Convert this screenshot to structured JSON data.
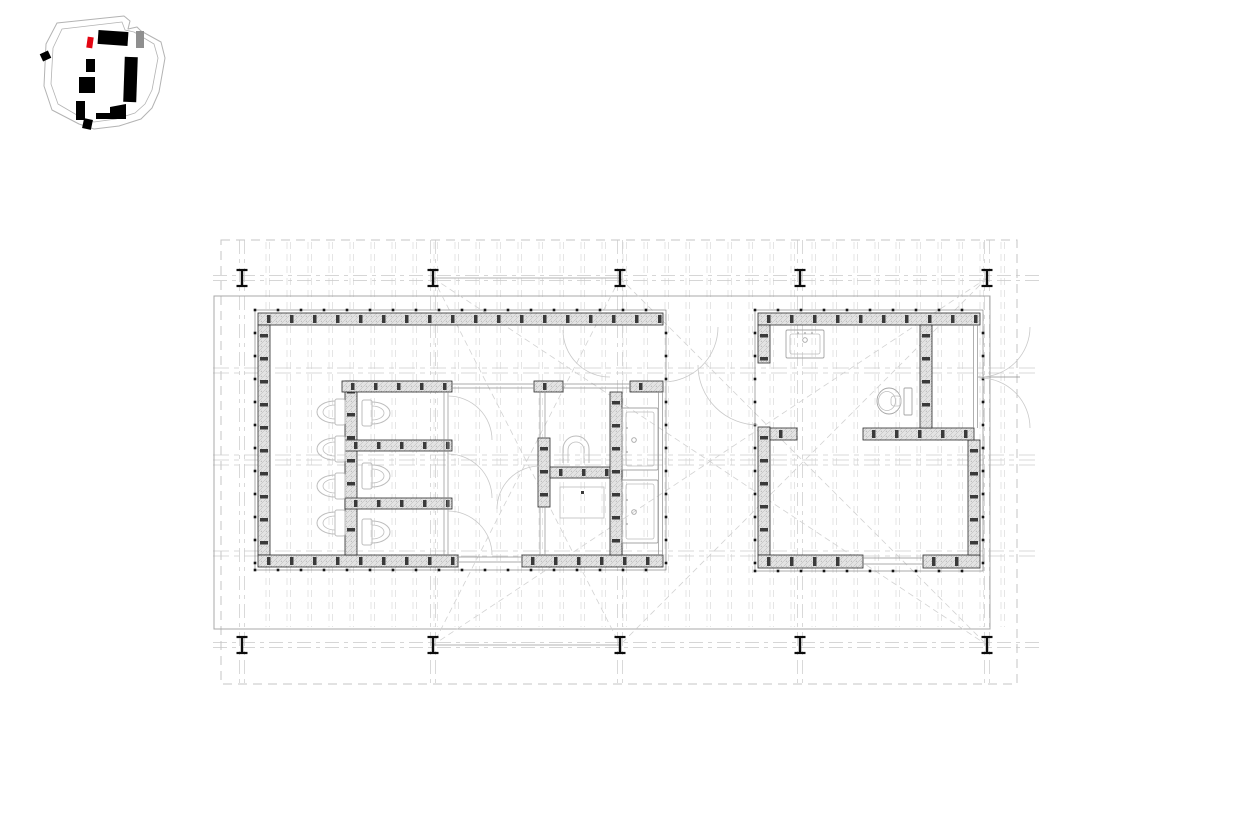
{
  "page": {
    "background": "#ffffff",
    "description": "architectural floor plan, ground level, two pavilions on a deck with column grid and site key map"
  },
  "palette": {
    "wall_edge": "#2b2b2b",
    "wall_fill": "#e3e3e3",
    "hatch_line": "#b4b4b4",
    "hatch_dot": "#9c9c9c",
    "stud": "#3a3a3a",
    "trim": "#707070",
    "trim_dot": "#161616",
    "glazing": "#8f8f8f",
    "fixture_light": "#bdbdbd",
    "fixture_mid": "#a6a6a6",
    "arc": "#c9c9c9",
    "board": "#dadada",
    "grid": "#c9c9c9",
    "boundary": "#c6c6c6",
    "utility": "#cccccc",
    "deck_edge": "#a8a8a8",
    "canopy": "#b3b3b3",
    "brace": "#d2d2d2",
    "column": "#0d0d0d",
    "site_outline": "#b3b3b3",
    "site_building": "#000000",
    "site_highlight": "#e30613",
    "site_secondary": "#8f8f8f"
  },
  "site_map": {
    "outer_outline": "57,23 124,16 130,21 128,29 137,27 141,31 161,42 165,58 159,92 152,108 141,119 119,126 94,129 79,124 52,110 44,86 46,44",
    "inner_outline": "62,29 122,22 125,30 134,32 154,44 158,58 152,90 145,104 135,113 116,119 94,122 82,118 58,104 51,84 53,48",
    "buildings": [
      {
        "x": 98,
        "y": 31,
        "w": 30,
        "h": 14,
        "rot": 4,
        "type": "building"
      },
      {
        "x": 136,
        "y": 31,
        "w": 8,
        "h": 17,
        "rot": 0,
        "type": "secondary"
      },
      {
        "x": 41,
        "y": 52,
        "w": 9,
        "h": 8,
        "rot": -25,
        "type": "building"
      },
      {
        "x": 86,
        "y": 59,
        "w": 9,
        "h": 13,
        "rot": 0,
        "type": "building"
      },
      {
        "x": 79,
        "y": 77,
        "w": 16,
        "h": 16,
        "rot": 0,
        "type": "building"
      },
      {
        "x": 124,
        "y": 57,
        "w": 13,
        "h": 45,
        "rot": 2,
        "type": "building"
      },
      {
        "x": 76,
        "y": 101,
        "w": 9,
        "h": 19,
        "rot": 0,
        "type": "building"
      },
      {
        "x": 83,
        "y": 119,
        "w": 9,
        "h": 10,
        "rot": 12,
        "type": "building"
      },
      {
        "x": 87,
        "y": 37,
        "w": 6,
        "h": 11,
        "rot": 8,
        "type": "highlight"
      }
    ],
    "steps_polygon": "96,113 110,113 110,107 126,104 126,119 96,119"
  },
  "plan": {
    "boundary": [
      221,
      240,
      796,
      444
    ],
    "deck": [
      214,
      296,
      776,
      333
    ],
    "grid": {
      "cols": [
        242,
        433,
        620,
        800,
        987
      ],
      "rows": [
        278,
        645
      ],
      "x1": 213,
      "x2": 1040,
      "y1": 240,
      "y2": 686,
      "offset": 2.5
    },
    "column_size": {
      "half_w": 5.5,
      "half_h": 8
    },
    "canopy_lines": [
      [
        433,
        278,
        620,
        278
      ],
      [
        433,
        645,
        620,
        645
      ]
    ],
    "braces": [
      [
        433,
        278,
        620,
        645
      ],
      [
        620,
        278,
        433,
        645
      ],
      [
        620,
        278,
        987,
        645
      ],
      [
        987,
        278,
        620,
        645
      ],
      [
        433,
        278,
        987,
        645
      ],
      [
        987,
        278,
        433,
        645
      ]
    ],
    "utility_ys": [
      368,
      373,
      455,
      460,
      465,
      551,
      556
    ],
    "utility_x": [
      213,
      1040
    ],
    "boards": {
      "x_start": 266,
      "x_end": 1002,
      "step": 21,
      "pair": 3.5,
      "y1": 242,
      "y2": 627
    },
    "buildings": [
      {
        "name": "building-left",
        "trim": [
          255,
          310,
          411,
          260
        ],
        "walls": [
          [
            258,
            313,
            405,
            12
          ],
          [
            258,
            325,
            12,
            230
          ],
          [
            258,
            555,
            200,
            12
          ],
          [
            522,
            555,
            141,
            12
          ],
          [
            345,
            381,
            12,
            174
          ],
          [
            342,
            381,
            110,
            11
          ],
          [
            534,
            381,
            29,
            11
          ],
          [
            630,
            381,
            33,
            11
          ],
          [
            345,
            440,
            107,
            11
          ],
          [
            345,
            498,
            107,
            11
          ],
          [
            538,
            438,
            12,
            69
          ],
          [
            550,
            467,
            60,
            11
          ],
          [
            610,
            392,
            12,
            163
          ]
        ],
        "glazings": [
          [
            444,
            392,
            444,
            555
          ],
          [
            448,
            392,
            448,
            555
          ],
          [
            452,
            384,
            534,
            384
          ],
          [
            452,
            388,
            534,
            388
          ],
          [
            563,
            384,
            630,
            384
          ],
          [
            563,
            388,
            630,
            388
          ],
          [
            658.5,
            392,
            658.5,
            555
          ],
          [
            662.5,
            392,
            662.5,
            555
          ],
          [
            458,
            557,
            522,
            557
          ],
          [
            458,
            562,
            522,
            562
          ],
          [
            540,
            392,
            540,
            438
          ],
          [
            545,
            392,
            545,
            438
          ],
          [
            540,
            507,
            540,
            555
          ],
          [
            545,
            507,
            545,
            555
          ]
        ],
        "door_arcs": [
          [
            663,
            327,
            55,
            0,
            90,
            1
          ],
          [
            610,
            330,
            47,
            180,
            90,
            0
          ],
          [
            540,
            509,
            43,
            180,
            270,
            1
          ],
          [
            448,
            440,
            44,
            270,
            360,
            1
          ],
          [
            448,
            498,
            44,
            270,
            360,
            1
          ],
          [
            448,
            555,
            44,
            270,
            360,
            1
          ]
        ],
        "toilets": [
          {
            "tank_x": 335,
            "cy": 412,
            "dir": "w"
          },
          {
            "tank_x": 335,
            "cy": 449,
            "dir": "w"
          },
          {
            "tank_x": 335,
            "cy": 486,
            "dir": "w"
          },
          {
            "tank_x": 335,
            "cy": 523,
            "dir": "w"
          },
          {
            "tank_x": 362,
            "cy": 413,
            "dir": "e"
          },
          {
            "tank_x": 362,
            "cy": 476,
            "dir": "e"
          },
          {
            "tank_x": 362,
            "cy": 532,
            "dir": "e"
          }
        ],
        "sinks": [
          {
            "rect": [
              622,
              408,
              36,
              62
            ],
            "faucet": [
              634,
              440
            ],
            "dots": [
              [
                627,
                428
              ],
              [
                627,
                452
              ]
            ]
          },
          {
            "rect": [
              622,
              480,
              36,
              63
            ],
            "faucet": [
              634,
              512
            ],
            "dots": [
              [
                627,
                500
              ],
              [
                627,
                524
              ]
            ]
          }
        ],
        "urinal": {
          "cx": 576,
          "base_y": 463,
          "r_out": 13,
          "r_in": 8
        },
        "shower": {
          "rect": [
            560,
            487,
            44,
            31
          ],
          "dot": [
            581,
            491
          ]
        }
      },
      {
        "name": "building-right",
        "trim": [
          755,
          310,
          228,
          261
        ],
        "walls": [
          [
            758,
            313,
            222,
            12
          ],
          [
            758,
            325,
            12,
            38
          ],
          [
            758,
            427,
            12,
            128
          ],
          [
            758,
            555,
            105,
            13
          ],
          [
            923,
            555,
            57,
            13
          ],
          [
            968,
            440,
            12,
            115
          ],
          [
            770,
            428,
            27,
            12
          ],
          [
            863,
            428,
            111,
            12
          ],
          [
            920,
            325,
            12,
            103
          ]
        ],
        "glazings": [
          [
            973.5,
            325,
            973.5,
            428
          ],
          [
            977.5,
            325,
            977.5,
            428
          ],
          [
            863,
            558,
            923,
            558
          ],
          [
            863,
            564,
            923,
            564
          ],
          [
            978,
            377,
            1020,
            377
          ]
        ],
        "door_arcs": [
          [
            758,
            365,
            60,
            180,
            90,
            0
          ],
          [
            980,
            327,
            50,
            0,
            90,
            1
          ],
          [
            980,
            428,
            50,
            270,
            360,
            1
          ]
        ],
        "toilets": [],
        "sinks": [
          {
            "rect": [
              786,
              330,
              38,
              28
            ],
            "faucet": [
              805,
              340
            ],
            "dots": [
              [
                798,
                333
              ],
              [
                805,
                333
              ],
              [
                812,
                333
              ]
            ]
          }
        ],
        "closet": {
          "cistern": [
            904,
            388,
            8,
            27
          ],
          "bowl": [
            889,
            401,
            12,
            13
          ],
          "inner": [
            887,
            401,
            8.5,
            9.5
          ],
          "seat": [
            891,
            396,
            10,
            10
          ]
        }
      }
    ]
  }
}
